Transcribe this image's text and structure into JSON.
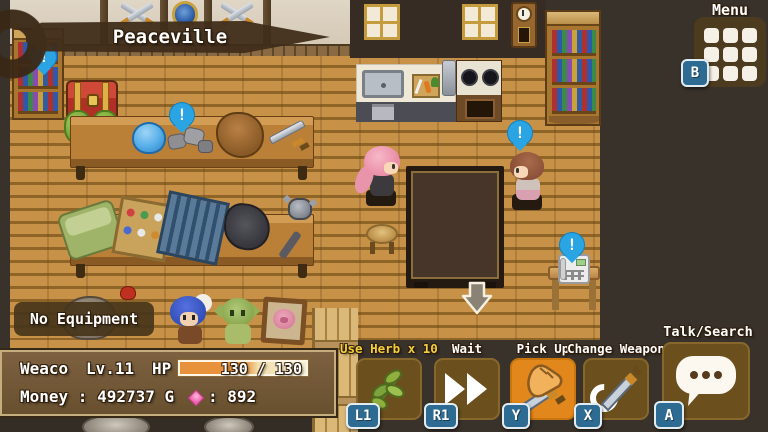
{
  "hud": {
    "location_banner": {
      "label": "Peaceville"
    },
    "menu_button": {
      "label": "Menu",
      "key": "B",
      "icon": "menu-grid-icon"
    },
    "equipment_label": "No Equipment",
    "stats_panel": {
      "character_name": "Weaco",
      "level": "Lv.11",
      "hp_label": "HP",
      "hp_value": "130 / 130",
      "hp_current": 130,
      "hp_max": 130,
      "hp_fill_width": "100%",
      "money": "Money : 492737 G",
      "gem_icon": "pink-gem-icon",
      "gem_count": ": 892"
    },
    "action_buttons": [
      {
        "label": "Use Herb x 10",
        "key": "L1",
        "icon": "herb-icon",
        "label_color": "#f2cf3e",
        "highlighted": false
      },
      {
        "label": "Wait",
        "key": "R1",
        "icon": "fast-forward-icon",
        "label_color": "#ffffff",
        "highlighted": false
      },
      {
        "label": "Pick Up",
        "key": "Y",
        "icon": "hand-pickup-icon",
        "label_color": "#ffffff",
        "highlighted": true
      },
      {
        "label": "Change Weapon",
        "key": "X",
        "icon": "swap-weapon-icon",
        "label_color": "#ffffff",
        "highlighted": false
      },
      {
        "label": "Talk/Search",
        "key": "A",
        "icon": "speech-bubble-icon",
        "label_color": "#ffffff",
        "highlighted": false
      }
    ]
  },
  "scene": {
    "alert_glyph": "!",
    "alert_bubbles": [
      "bookshelf-top-left",
      "ore-rocks-table",
      "npc-brown-hair",
      "telephone-desk"
    ],
    "objects": [
      "bookshelf-left",
      "bookshelf-right",
      "crossed-swords",
      "shield",
      "windows",
      "wall-clock",
      "treasure-chest",
      "cabbage-crate",
      "shop-table-1",
      "slime-hat",
      "ore-rocks",
      "fur-pelt",
      "sword-item",
      "shop-table-2",
      "bed-roll",
      "potion-crate",
      "metal-rack",
      "black-pelt",
      "mace",
      "kitchen-sink",
      "cutting-board",
      "stove",
      "oven",
      "big-table",
      "stool",
      "player-pink-hair",
      "npc-brown-hair",
      "down-arrow",
      "telephone",
      "rock-sack",
      "blue-hair-doll",
      "goblin-doll",
      "framed-picture",
      "storage-crates",
      "clay-pots"
    ]
  },
  "colors": {
    "background": "#39322b",
    "floor": "#c38e44",
    "accent_orange": "#e1871c",
    "panel_brown": "#6b5233",
    "badge_blue": "#2e6b92",
    "alert_blue": "#2aa4e3",
    "hp_orange": "#e8923c",
    "label_yellow": "#f2cf3e"
  }
}
